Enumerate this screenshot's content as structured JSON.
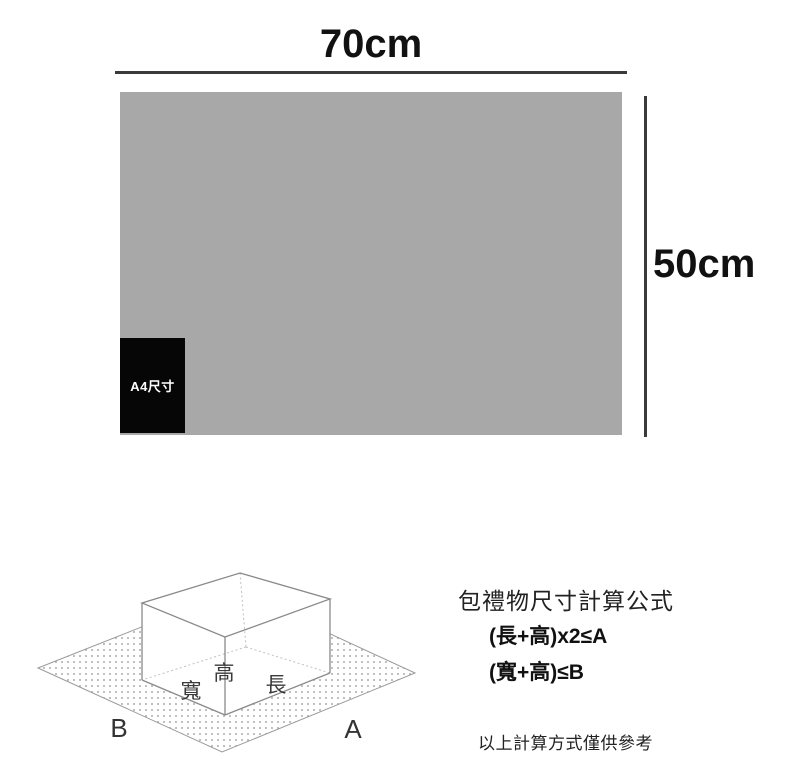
{
  "colors": {
    "paper_gray": "#a8a8a8",
    "dimension_line": "#3a3a3a",
    "a4_black": "#060606",
    "a4_text": "#ffffff",
    "box_edge": "#8a8a8a",
    "box_hidden_edge": "#c0c0c0",
    "sheet_dot": "#ababab",
    "text_dark": "#111111"
  },
  "paper": {
    "width_label": "70cm",
    "height_label": "50cm",
    "a4_label": "A4尺寸"
  },
  "diagram": {
    "width_label": "寬",
    "height_label": "高",
    "length_label": "長",
    "side_b_label": "B",
    "side_a_label": "A"
  },
  "formula": {
    "title": "包禮物尺寸計算公式",
    "line1": "(長+高)x2≤A",
    "line2": "(寬+高)≤B",
    "note": "以上計算方式僅供參考"
  }
}
